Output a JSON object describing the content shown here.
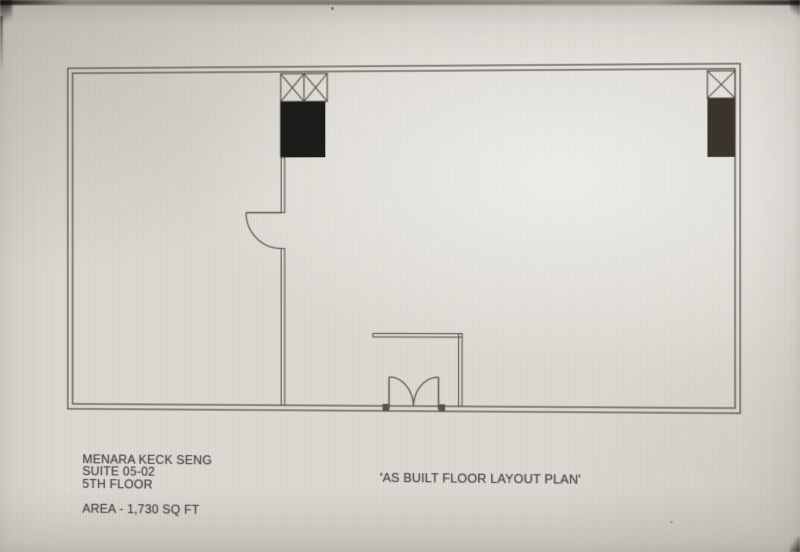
{
  "labels": {
    "building": "MENARA KECK SENG",
    "suite": "SUITE 05-02",
    "floor": "5TH FLOOR",
    "area": "AREA - 1,730 SQ FT",
    "plan_title": "'AS BUILT FLOOR LAYOUT PLAN'"
  },
  "colors": {
    "paper": "#dcd9d2",
    "line": "#57544d",
    "column_black": "#1c1c1a",
    "column_brown": "#3b342b",
    "photo_edge": "#15140f",
    "text": "#454240"
  },
  "plan": {
    "elements": [
      {
        "t": "rect",
        "name": "outer-wall-outline",
        "x": 63,
        "y": 66,
        "w": 673,
        "h": 345
      },
      {
        "t": "rect",
        "name": "outer-wall-inner-line",
        "x": 68,
        "y": 71,
        "w": 663,
        "h": 335
      },
      {
        "t": "hatch",
        "name": "left-column-hatch-box",
        "x": 280,
        "y": 73,
        "w": 47,
        "h": 28,
        "cells": 2
      },
      {
        "t": "fill",
        "name": "left-column",
        "x": 279.5,
        "y": 101,
        "w": 45.5,
        "h": 56,
        "fill": "black"
      },
      {
        "t": "hatch",
        "name": "right-column-hatch-box",
        "x": 704,
        "y": 73,
        "w": 27,
        "h": 27,
        "cells": 1
      },
      {
        "t": "fill",
        "name": "right-column",
        "x": 704,
        "y": 100,
        "w": 27,
        "h": 58,
        "fill": "brown"
      },
      {
        "t": "hrect",
        "name": "partition-wall-upper",
        "x": 280.5,
        "y": 157,
        "w": 3.5,
        "h": 55.5
      },
      {
        "t": "hrect",
        "name": "partition-wall-lower",
        "x": 280.5,
        "y": 248.5,
        "w": 3.5,
        "h": 157.5
      },
      {
        "t": "hrect",
        "name": "vestibule-wall-top",
        "x": 373,
        "y": 333.5,
        "w": 89,
        "h": 3.5
      },
      {
        "t": "hrect",
        "name": "vestibule-wall-right",
        "x": 458.5,
        "y": 333.5,
        "w": 3.5,
        "h": 72.5
      },
      {
        "t": "line",
        "name": "office-door-leaf",
        "x1": 245,
        "y1": 212.5,
        "x2": 280.5,
        "y2": 212.5
      },
      {
        "t": "path",
        "name": "office-door-swing-arc",
        "d": "M 245 212.5 A 35.5 36 0 0 0 280.5 248.5"
      },
      {
        "t": "line",
        "name": "entrance-door-left-leaf",
        "x1": 389,
        "y1": 377,
        "x2": 389,
        "y2": 409
      },
      {
        "t": "line",
        "name": "entrance-door-right-leaf",
        "x1": 438.5,
        "y1": 377,
        "x2": 438.5,
        "y2": 409
      },
      {
        "t": "path",
        "name": "entrance-door-left-swing-arc",
        "d": "M 389 377 A 24.5 30 0 0 1 413.5 406"
      },
      {
        "t": "path",
        "name": "entrance-door-right-swing-arc",
        "d": "M 438.5 377 A 25 30 0 0 0 413.5 406"
      },
      {
        "t": "fill",
        "name": "entrance-door-left-jamb",
        "x": 382.5,
        "y": 404,
        "w": 6.5,
        "h": 7.3,
        "fill": "line"
      },
      {
        "t": "fill",
        "name": "entrance-door-right-jamb",
        "x": 438.5,
        "y": 404,
        "w": 6.5,
        "h": 7.3,
        "fill": "line"
      }
    ]
  }
}
